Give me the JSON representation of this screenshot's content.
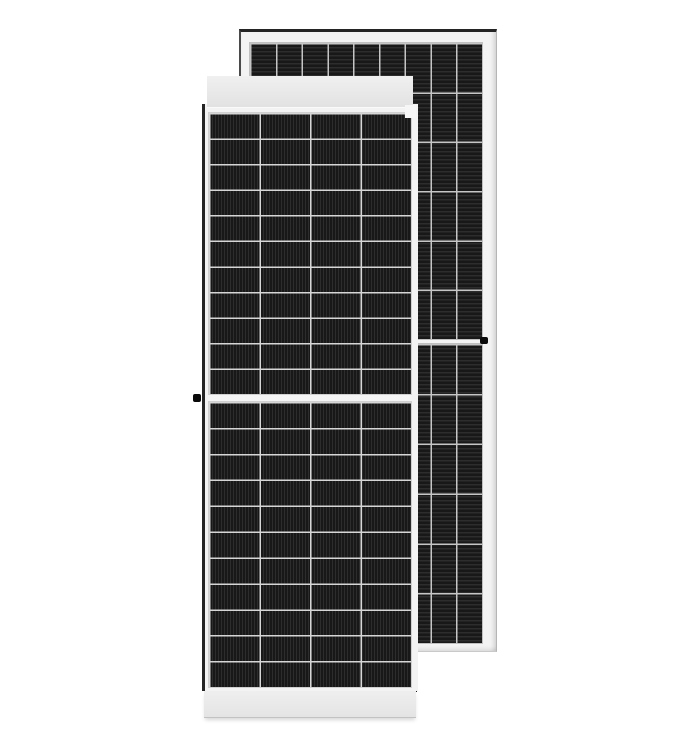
{
  "image": {
    "type": "product-photo",
    "background_color": "#ffffff",
    "front_panel_label": "framed half-cut solar panel, front view",
    "back_panel_label": "solar panel behind, offset upper right"
  },
  "colors": {
    "bg": "#ffffff",
    "frame": "#f3f3f3",
    "cell_base": "#181818",
    "stripe": "#ffffff17",
    "grid_front": "#d6d6d6",
    "grid_back": "#c6c6c6",
    "gap": "#f4f4f4",
    "edge_dark": "#242424",
    "outline": "#b5b5b5",
    "band_hi": "#f0f0f0",
    "band_lo": "#e2e2e2",
    "dot": "#0a0a0a"
  },
  "grids": {
    "fp_cols": 4,
    "fp_rows_half": 11,
    "bp_cols": 9,
    "bp_rows_half": 6
  },
  "front_panel": {
    "cell_columns": 4,
    "cell_rows_total": 22,
    "halves": 2,
    "stripe_direction": "vertical",
    "has_center_gap": true,
    "has_grounding_dot": true
  },
  "back_panel": {
    "cell_columns": 9,
    "cell_rows_total": 12,
    "halves": 2,
    "stripe_direction": "horizontal",
    "has_center_divider": true,
    "has_grounding_dot": true
  }
}
